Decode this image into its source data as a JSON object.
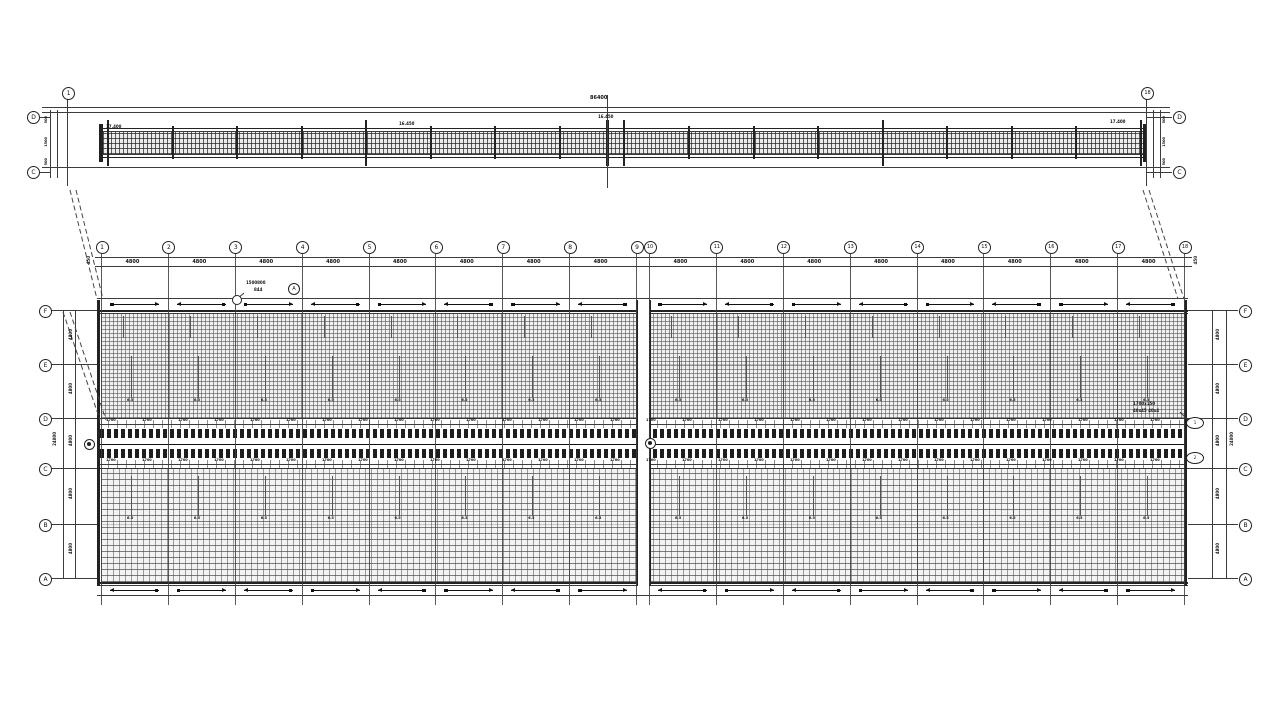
{
  "top_section": {
    "left_grid": "1",
    "right_grid": "18",
    "left_rows": [
      "D",
      "C"
    ],
    "right_rows": [
      "D",
      "C"
    ],
    "total_dim": "86400",
    "elev_mid": "16.450",
    "elev_mid2": "16.450",
    "end_dim_left": "17.400",
    "end_dim_right": "17.400",
    "side_dims_left": [
      "500",
      "1500",
      "500"
    ],
    "side_dims_right": [
      "500",
      "1500",
      "500"
    ]
  },
  "plan": {
    "grids": [
      "1",
      "2",
      "3",
      "4",
      "5",
      "6",
      "7",
      "8",
      "9",
      "10",
      "11",
      "12",
      "13",
      "14",
      "15",
      "16",
      "17",
      "18"
    ],
    "rows_left": [
      "F",
      "E",
      "D",
      "C",
      "B",
      "A"
    ],
    "rows_right": [
      "F",
      "E",
      "D",
      "C",
      "B",
      "A"
    ],
    "bay_dim": "4800",
    "end_dim": "450",
    "row_dim": "4800",
    "row_total_left": "24000",
    "row_total_right": "24000",
    "mid_dim": "1700",
    "stem_label": "6.5",
    "callout_a": {
      "line1": "1500800",
      "line2": "844",
      "ref": "A"
    },
    "callout_b": {
      "line1": "1700x150",
      "line2": "40x45 40x4"
    },
    "detail_ref_top": "1",
    "detail_ref_bottom": "2"
  }
}
